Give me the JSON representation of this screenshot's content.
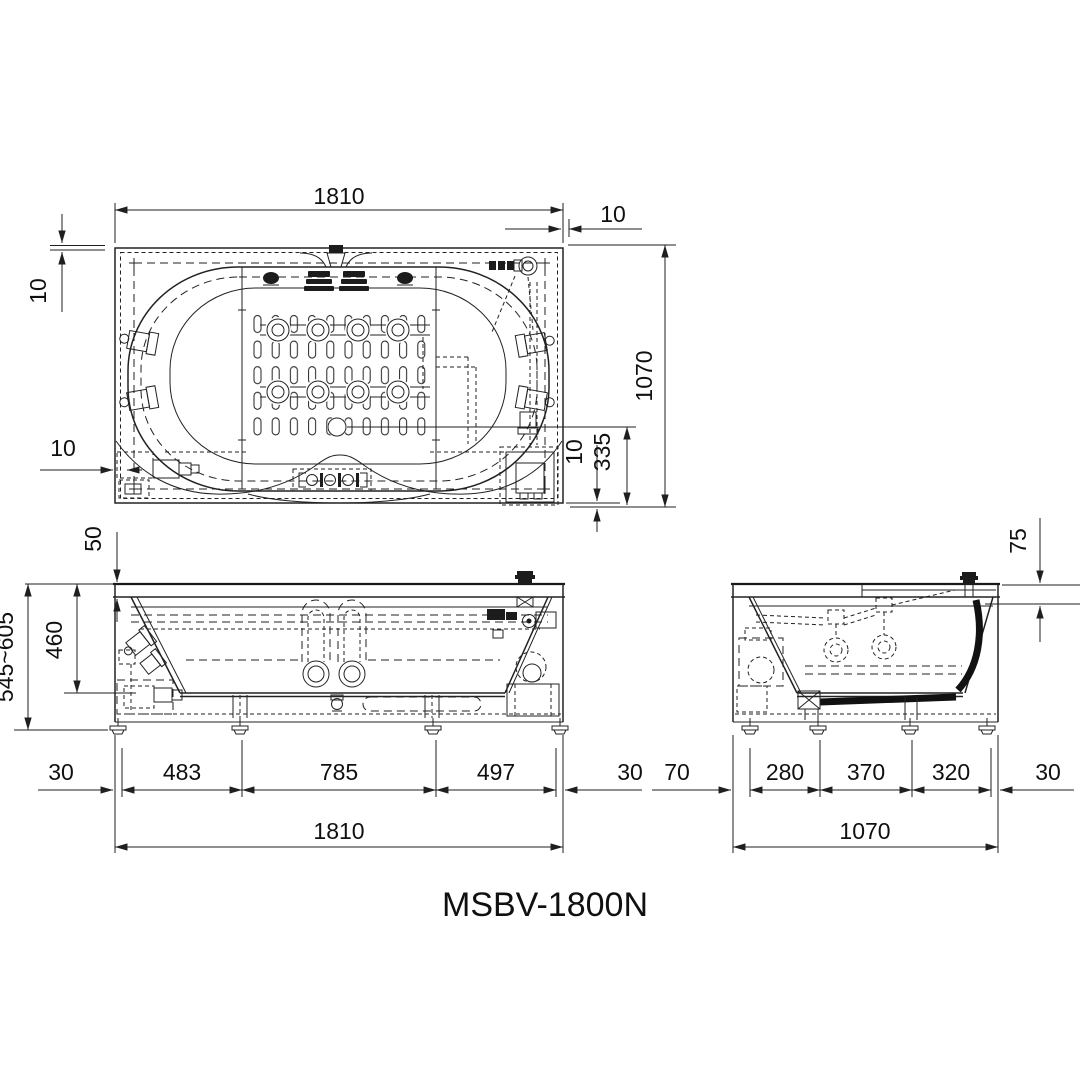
{
  "title": {
    "model": "MSBV-1800N"
  },
  "colors": {
    "line": "#222222",
    "text": "#101010",
    "background": "#ffffff"
  },
  "top_view": {
    "dims": {
      "overall_width": "1810",
      "overhang_right": "10",
      "overhang_top": "10",
      "overall_depth": "1070",
      "drain_center_offset": "335",
      "overhang_bottom": "10",
      "overhang_left": "10"
    }
  },
  "front_view": {
    "dims": {
      "rim_thickness": "50",
      "inner_depth": "460",
      "height_range": "545~605",
      "margin_left": "30",
      "span_1": "483",
      "span_2": "785",
      "span_3": "497",
      "margin_right": "30",
      "overall_width": "1810"
    }
  },
  "side_view": {
    "dims": {
      "deck_drop": "75",
      "margin_left": "70",
      "span_1": "280",
      "span_2": "370",
      "span_3": "320",
      "margin_right": "30",
      "overall_width": "1070"
    }
  }
}
